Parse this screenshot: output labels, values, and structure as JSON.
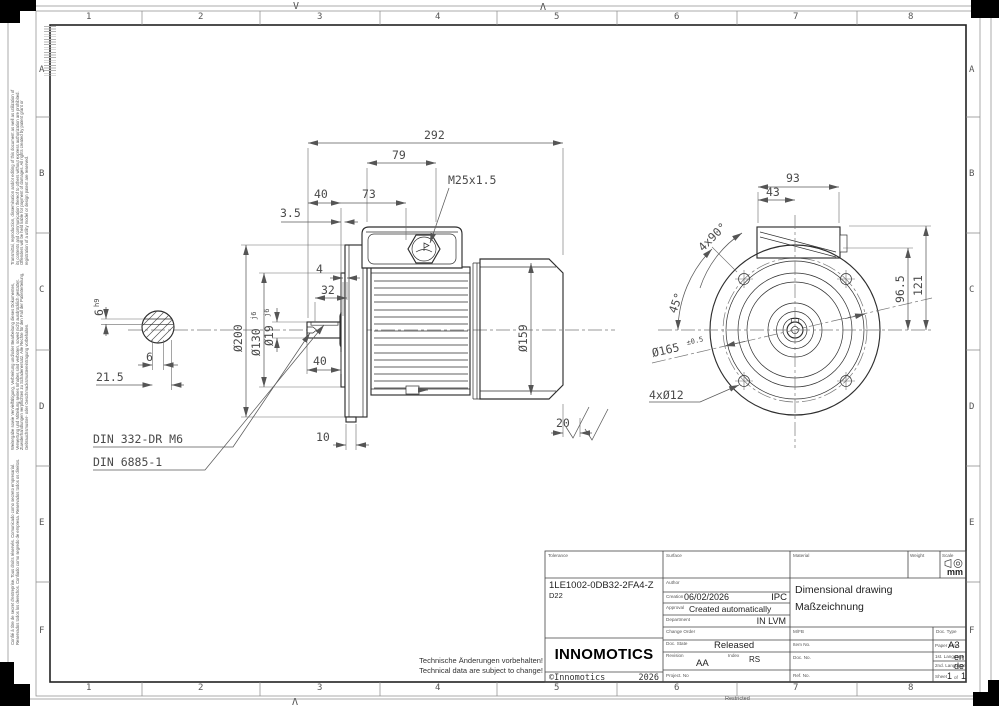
{
  "sheet": {
    "cols": [
      "1",
      "2",
      "3",
      "4",
      "5",
      "6",
      "7",
      "8"
    ],
    "rows": [
      "A",
      "B",
      "C",
      "D",
      "E",
      "F"
    ],
    "fold_top_left": "V",
    "fold_top_right": "Λ",
    "fold_bottom": "Λ",
    "restricted": "Restricted"
  },
  "legal": {
    "en": "Transmittal, reproduction, dissemination and/or editing of this document as well as utilization of its contents and communication thereof to others without express authorization are prohibited. Offenders will be held liable for payment of damages. All rights created by patent grant or registration of a utility model or design patent are reserved.",
    "de": "Weitergabe sowie Vervielfältigung, Verbreitung und/oder Bearbeitung dieses Dokumentes, Verwertung und Mitteilung seines Inhaltes sind verboten, soweit nicht ausdrücklich gestattet. Zuwiderhandlungen verpflichten zu Schadenersatz. Alle Rechte für den Fall der Patenterteilung, Gebrauchsmuster- oder Geschmacksmustereintragung vorbehalten.",
    "other": "Confié à titre de secret d'entreprise. Tous droits réservés. Comunicado como secreto empresarial. Reservados todos los derechos. Confiado como segredo de empresa. Reservados todos os direitos."
  },
  "notes": {
    "de": "Technische Änderungen vorbehalten!",
    "en": "Technical data are subject to change!"
  },
  "side": {
    "total": "292",
    "box": "79",
    "gland": "M25x1.5",
    "shaft_len": "40",
    "to_gland": "73",
    "offset": "3.5",
    "step": "4",
    "hub": "32",
    "shaft_dia": "Ø19",
    "shaft_tol": "j6",
    "flange_dia": "Ø200",
    "spigot_dia": "Ø130",
    "spigot_tol": "j6",
    "key_len": "40",
    "foot": "10",
    "frame_dia": "Ø159",
    "rear": "20",
    "key_h": "6",
    "key_h_tol": "h9",
    "key_w": "6",
    "key_off": "21.5",
    "din_center": "DIN 332-DR M6",
    "din_key": "DIN 6885-1"
  },
  "front": {
    "box_w": "93",
    "box_half": "43",
    "angle_holes": "4x90°",
    "angle": "45°",
    "h_box": "96.5",
    "h_top": "121",
    "bolt_circle": "Ø165",
    "bolt_tol": "±0.5",
    "holes": "4xØ12"
  },
  "tb": {
    "labels": {
      "tolerance": "Tolerance",
      "surface": "Surface",
      "material": "Material",
      "weight": "Weight",
      "scale": "Scale",
      "author": "Author",
      "creation": "Creation",
      "approval": "Approval",
      "department": "Department",
      "change_order": "Change Order",
      "doc_state": "Doc. State",
      "revision": "Revision",
      "index": "Index",
      "project_no": "Project. No",
      "mfb": "M/FB",
      "doc_type": "Doc. Type",
      "item_no": "Item No.",
      "paper_size": "Paper Size",
      "lang1": "1st. Language",
      "lang2": "2nd. Language",
      "doc_no": "Doc. No.",
      "ref_no": "Ref. No.",
      "sheet": "Sheet",
      "of": "of"
    },
    "values": {
      "part_number": "1LE1002-0DB32-2FA4-Z",
      "variant": "D22",
      "creation_date": "06/02/2026",
      "creation_org": "IPC",
      "approval": "Created automatically",
      "department": "IN LVM",
      "doc_state": "Released",
      "revision": "AA",
      "index": "RS",
      "paper_size": "A3",
      "lang1": "en",
      "lang2": "de",
      "sheet_no": "1",
      "sheet_total": "1",
      "unit": "mm",
      "title_en": "Dimensional drawing",
      "title_de": "Maßzeichnung",
      "logo": "INNOMOTICS",
      "copyright": "©Innomotics",
      "year": "2026"
    }
  }
}
